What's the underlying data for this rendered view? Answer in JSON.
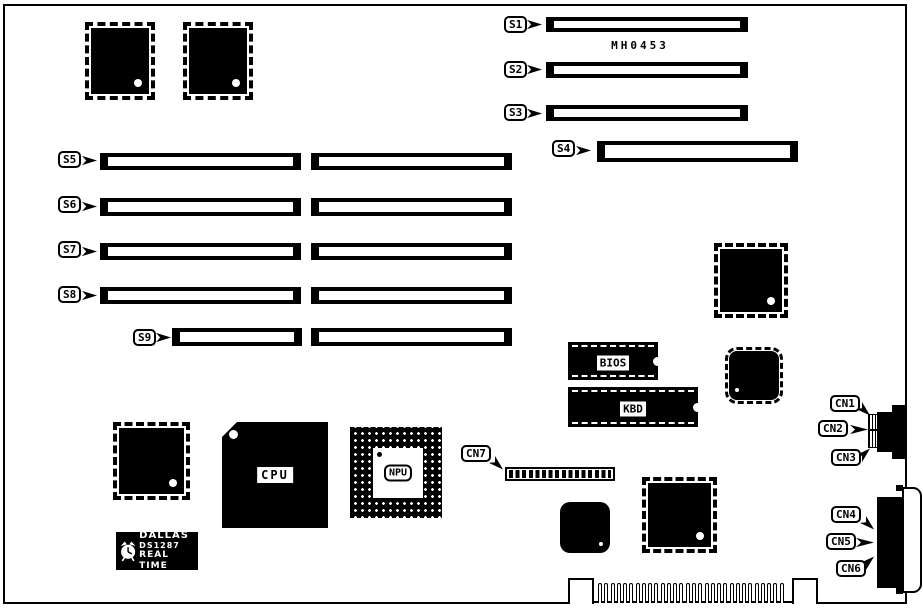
{
  "board": {
    "part_number": "MH0453",
    "ink_color": "#000000",
    "paper_color": "#ffffff"
  },
  "slot_labels": {
    "s1": "S1",
    "s2": "S2",
    "s3": "S3",
    "s4": "S4",
    "s5": "S5",
    "s6": "S6",
    "s7": "S7",
    "s8": "S8",
    "s9": "S9"
  },
  "connector_labels": {
    "cn1": "CN1",
    "cn2": "CN2",
    "cn3": "CN3",
    "cn4": "CN4",
    "cn5": "CN5",
    "cn6": "CN6",
    "cn7": "CN7"
  },
  "chip_labels": {
    "cpu": "CPU",
    "npu": "NPU",
    "bios": "BIOS",
    "kbd": "KBD",
    "rtc_brand": "DALLAS",
    "rtc_model": "DS1287",
    "rtc_type": "REAL TIME"
  },
  "icons": {
    "rtc_clock": "alarm-clock"
  }
}
